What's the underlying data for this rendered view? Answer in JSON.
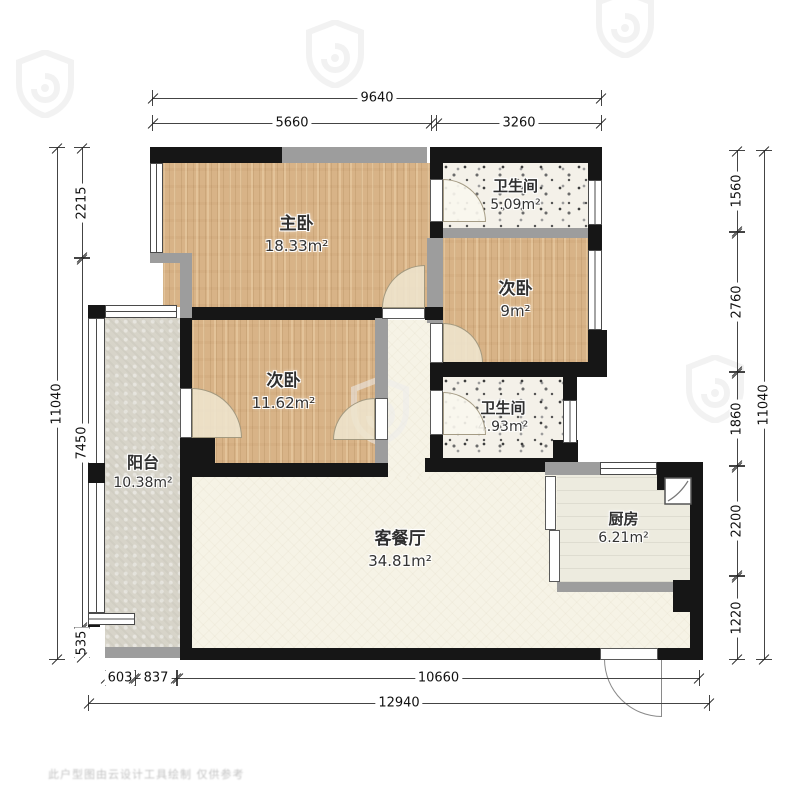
{
  "rooms": {
    "master": {
      "name": "主卧",
      "area": "18.33m²"
    },
    "bath_top": {
      "name": "卫生间",
      "area": "5.09m²"
    },
    "bed2_right": {
      "name": "次卧",
      "area": "9m²"
    },
    "bath_mid": {
      "name": "卫生间",
      "area": "4.93m²"
    },
    "bed2_left": {
      "name": "次卧",
      "area": "11.62m²"
    },
    "balcony": {
      "name": "阳台",
      "area": "10.38m²"
    },
    "living": {
      "name": "客餐厅",
      "area": "34.81m²"
    },
    "kitchen": {
      "name": "厨房",
      "area": "6.21m²"
    }
  },
  "dimensions": {
    "top": {
      "total": "9640",
      "segments": [
        "5660",
        "3260"
      ]
    },
    "left": {
      "total": "11040",
      "segments": [
        "2215",
        "7450",
        "535"
      ]
    },
    "right": {
      "total": "11040",
      "segments": [
        "1560",
        "2760",
        "1860",
        "2200",
        "1220"
      ]
    },
    "bottom": {
      "total": "12940",
      "segments": [
        "603",
        "837",
        "10660"
      ]
    }
  },
  "watermark": {
    "text": "此户型图由云设计工具绘制 仅供参考"
  },
  "icons": {
    "watermark_shield": "shield-curl-logo",
    "sink": "kitchen-corner-sink"
  },
  "colors": {
    "wall_black": "#161616",
    "wall_gray": "#9d9d9d",
    "wood": "#d8b387",
    "terrazzo": "#f4f1e9",
    "balcony_tile": "#d7d4c9",
    "living_cream": "#f6f3e6",
    "kitchen_floor": "#edebdf",
    "dim_line": "#444444"
  }
}
